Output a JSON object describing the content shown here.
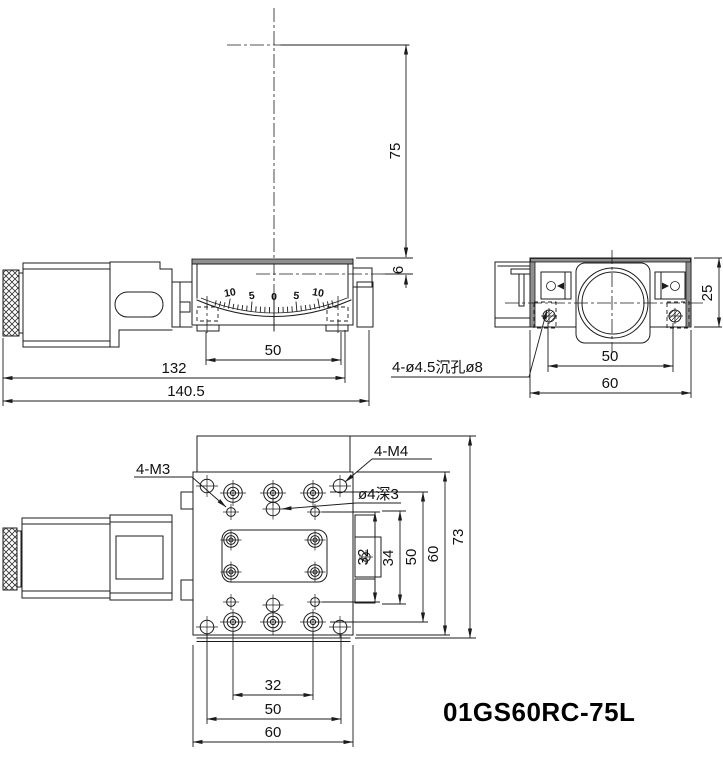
{
  "title_block": {
    "part_number": "01GS60RC-75L"
  },
  "side_view": {
    "scale_labels": [
      "10",
      "5",
      "0",
      "5",
      "10"
    ],
    "dims": {
      "pivot_height": "75",
      "top_offset": "6",
      "mount_span": "50",
      "body_length": "132",
      "overall_length": "140.5"
    }
  },
  "end_view": {
    "counterbore_note": "4-ø4.5沉孔ø8",
    "dims": {
      "height": "25",
      "hole_span": "50",
      "width": "60"
    }
  },
  "plan_view": {
    "labels": {
      "m3_holes": "4-M3",
      "m4_holes": "4-M4",
      "center_hole": "ø4深3"
    },
    "dims": {
      "row_m3": "32",
      "side_block": "34",
      "row_counterbore": "50",
      "plate_height": "60",
      "overall_height": "73",
      "col_counterbore": "32",
      "col_corner": "50",
      "plate_width": "60"
    }
  }
}
